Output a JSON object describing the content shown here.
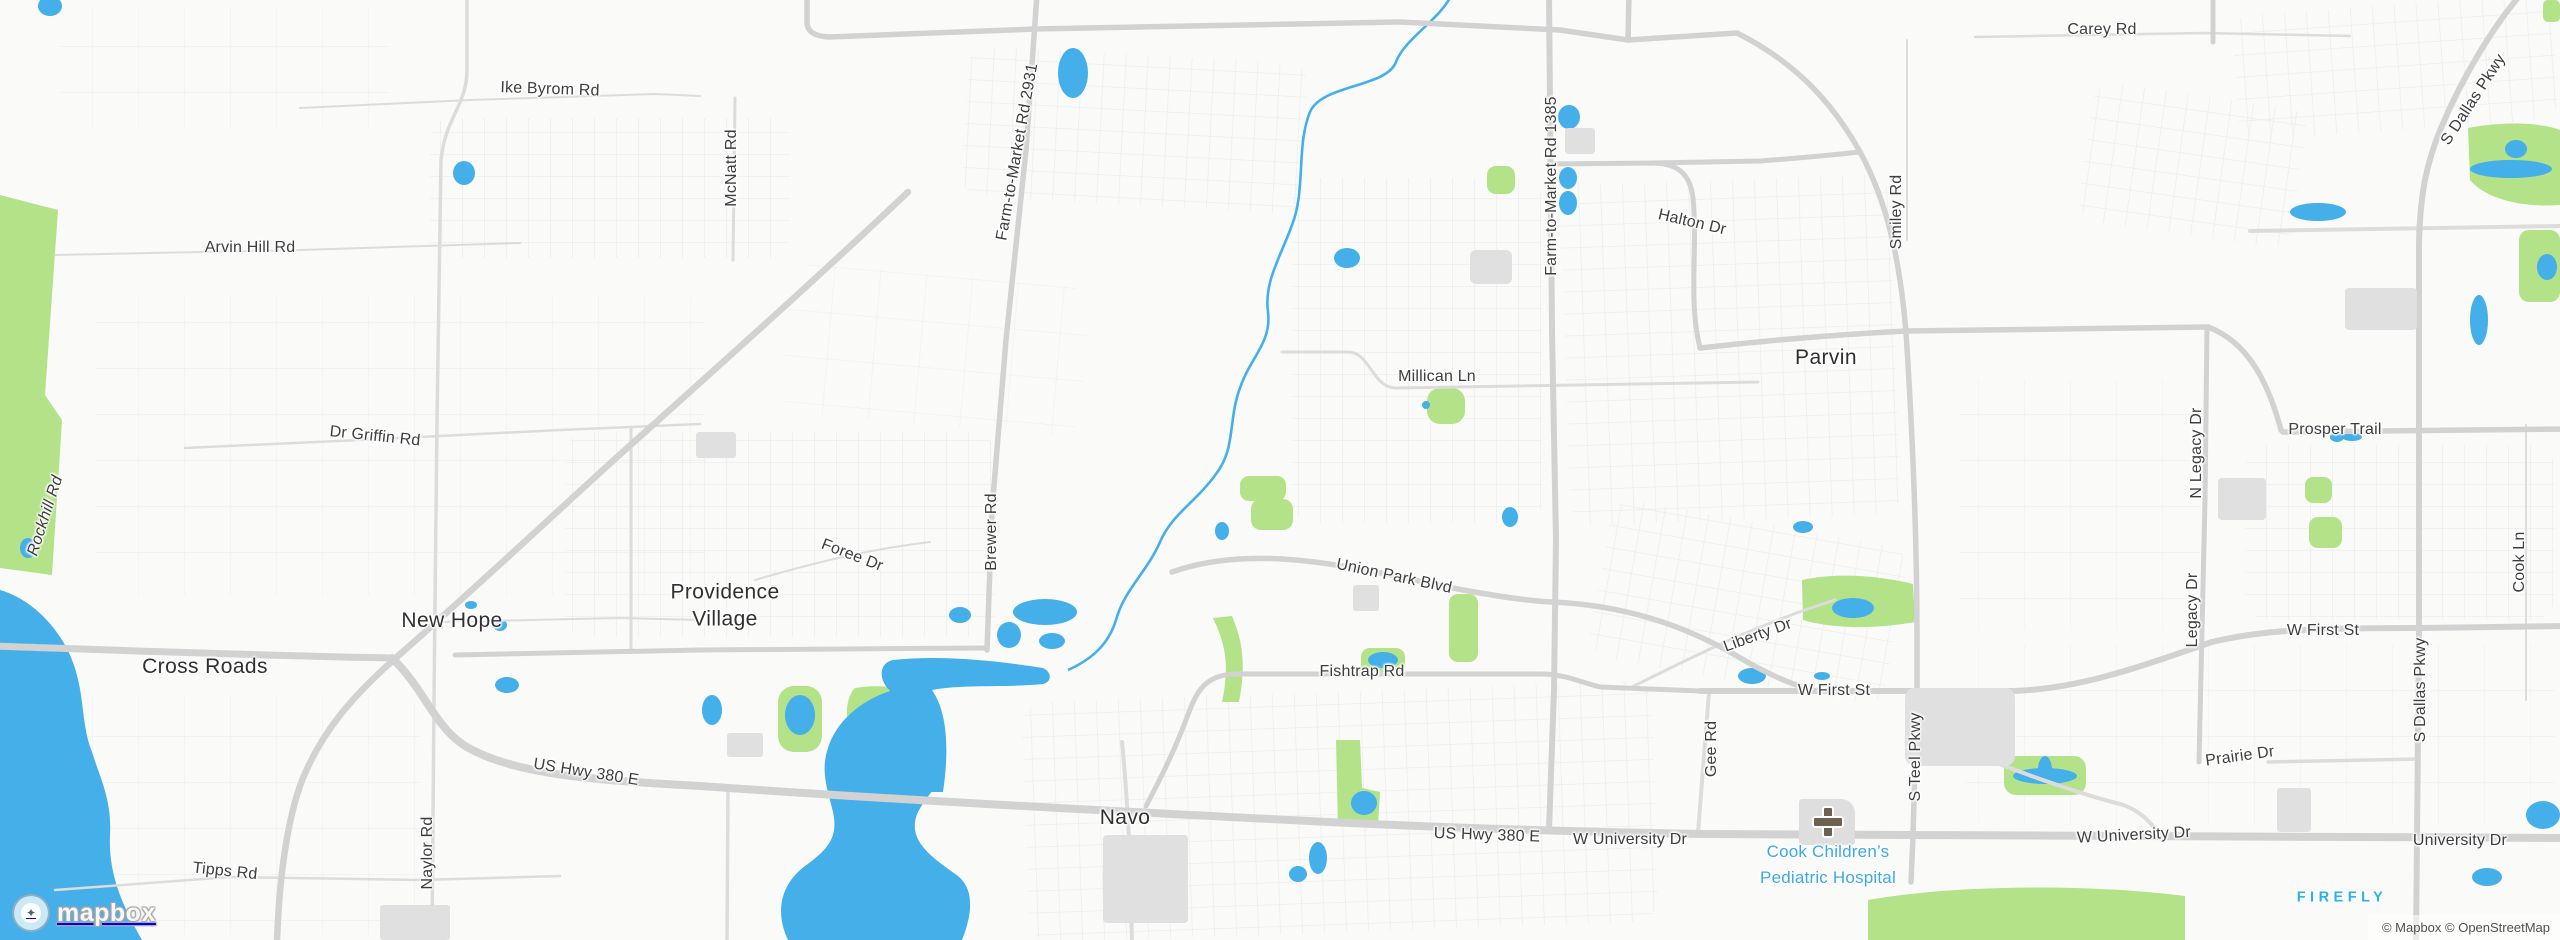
{
  "map": {
    "colors": {
      "land": "#fafaf9",
      "water": "#44afe8",
      "park": "#b3e288",
      "road_major": "#d2d2d2",
      "road_medium": "#dcdcdc",
      "road_minor": "#e7e7e7",
      "building": "#e0e0e0",
      "label_dark": "#3d3d3d",
      "poi_blue": "#3aa9e4",
      "brand_cyan": "#27b2e8"
    },
    "labels": [
      {
        "text": "Cross Roads",
        "x": 205,
        "y": 667,
        "rot": 0,
        "cls": "town"
      },
      {
        "text": "New Hope",
        "x": 452,
        "y": 621,
        "rot": 0,
        "cls": "town"
      },
      {
        "text": "Providence Village",
        "x": 725,
        "y": 606,
        "rot": 0,
        "cls": "town wrap"
      },
      {
        "text": "Navo",
        "x": 1125,
        "y": 818,
        "rot": 0,
        "cls": "town"
      },
      {
        "text": "Parvin",
        "x": 1826,
        "y": 358,
        "rot": 0,
        "cls": "town"
      },
      {
        "text": "Ike Byrom Rd",
        "x": 550,
        "y": 90,
        "rot": 2,
        "cls": "road"
      },
      {
        "text": "McNatt Rd",
        "x": 732,
        "y": 168,
        "rot": -90,
        "cls": "road"
      },
      {
        "text": "Farm-to-Market Rd 2931",
        "x": 1018,
        "y": 152,
        "rot": -80,
        "cls": "road"
      },
      {
        "text": "Arvin Hill Rd",
        "x": 250,
        "y": 248,
        "rot": 0,
        "cls": "road"
      },
      {
        "text": "Carey Rd",
        "x": 2102,
        "y": 30,
        "rot": 0,
        "cls": "road"
      },
      {
        "text": "Farm-to-Market Rd 1385",
        "x": 1552,
        "y": 186,
        "rot": -90,
        "cls": "road"
      },
      {
        "text": "Halton Dr",
        "x": 1692,
        "y": 223,
        "rot": 13,
        "cls": "road"
      },
      {
        "text": "Smiley Rd",
        "x": 1897,
        "y": 212,
        "rot": -90,
        "cls": "road"
      },
      {
        "text": "S Dallas Pkwy",
        "x": 2474,
        "y": 100,
        "rot": -57,
        "cls": "road"
      },
      {
        "text": "Millican Ln",
        "x": 1437,
        "y": 377,
        "rot": 0,
        "cls": "road"
      },
      {
        "text": "Dr Griffin Rd",
        "x": 375,
        "y": 437,
        "rot": 6,
        "cls": "road"
      },
      {
        "text": "Rockhill Rd",
        "x": 46,
        "y": 516,
        "rot": -72,
        "cls": "road italic"
      },
      {
        "text": "Prosper Trail",
        "x": 2335,
        "y": 430,
        "rot": 0,
        "cls": "road"
      },
      {
        "text": "N Legacy Dr",
        "x": 2197,
        "y": 453,
        "rot": -90,
        "cls": "road"
      },
      {
        "text": "Brewer Rd",
        "x": 992,
        "y": 532,
        "rot": -90,
        "cls": "road"
      },
      {
        "text": "Foree Dr",
        "x": 852,
        "y": 556,
        "rot": 21,
        "cls": "road"
      },
      {
        "text": "Union Park Blvd",
        "x": 1394,
        "y": 577,
        "rot": 12,
        "cls": "road"
      },
      {
        "text": "Cook Ln",
        "x": 2520,
        "y": 562,
        "rot": -90,
        "cls": "road"
      },
      {
        "text": "Legacy Dr",
        "x": 2193,
        "y": 610,
        "rot": -90,
        "cls": "road"
      },
      {
        "text": "W First St",
        "x": 2323,
        "y": 631,
        "rot": 0,
        "cls": "road"
      },
      {
        "text": "Liberty Dr",
        "x": 1758,
        "y": 636,
        "rot": -20,
        "cls": "road"
      },
      {
        "text": "W First St",
        "x": 1834,
        "y": 691,
        "rot": 0,
        "cls": "road"
      },
      {
        "text": "Fishtrap Rd",
        "x": 1362,
        "y": 672,
        "rot": 0,
        "cls": "road"
      },
      {
        "text": "S Teel Pkwy",
        "x": 1916,
        "y": 757,
        "rot": -90,
        "cls": "road"
      },
      {
        "text": "S Dallas Pkwy",
        "x": 2421,
        "y": 690,
        "rot": -90,
        "cls": "road"
      },
      {
        "text": "Prairie Dr",
        "x": 2240,
        "y": 757,
        "rot": -8,
        "cls": "road"
      },
      {
        "text": "US Hwy 380 E",
        "x": 586,
        "y": 773,
        "rot": 9,
        "cls": "road"
      },
      {
        "text": "Gee Rd",
        "x": 1712,
        "y": 749,
        "rot": -90,
        "cls": "road"
      },
      {
        "text": "Naylor Rd",
        "x": 428,
        "y": 853,
        "rot": -90,
        "cls": "road"
      },
      {
        "text": "US Hwy 380 E",
        "x": 1487,
        "y": 836,
        "rot": 2,
        "cls": "road"
      },
      {
        "text": "W University Dr",
        "x": 1630,
        "y": 840,
        "rot": 0,
        "cls": "road"
      },
      {
        "text": "W University Dr",
        "x": 2134,
        "y": 836,
        "rot": -3,
        "cls": "road"
      },
      {
        "text": "University Dr",
        "x": 2460,
        "y": 841,
        "rot": 0,
        "cls": "road"
      },
      {
        "text": "Tipps Rd",
        "x": 225,
        "y": 872,
        "rot": 6,
        "cls": "road"
      },
      {
        "text": "Cook Children’s",
        "x": 1828,
        "y": 852,
        "rot": 0,
        "cls": "poi"
      },
      {
        "text": "Pediatric Hospital",
        "x": 1828,
        "y": 878,
        "rot": 0,
        "cls": "poi"
      },
      {
        "text": "FIREFLY",
        "x": 2342,
        "y": 898,
        "rot": 0,
        "cls": "brand"
      }
    ],
    "poi": {
      "hospital_icon": "hospital-cross-icon"
    },
    "logo": {
      "wordmark": "mapbox",
      "badge_glyph": "✦"
    },
    "attribution": "© Mapbox © OpenStreetMap"
  }
}
